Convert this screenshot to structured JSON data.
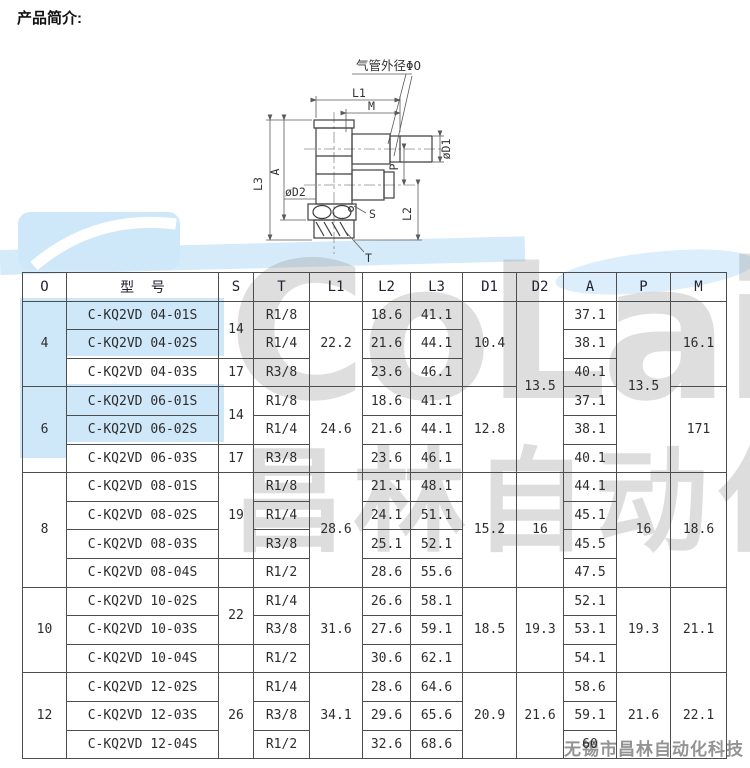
{
  "page": {
    "title": "产品简介:"
  },
  "watermark": {
    "brand": "CoLair",
    "cn": "昌林自动化",
    "footer": "无锡市昌林自动化科技",
    "blue": "#cfe8f9",
    "gray": "#919191"
  },
  "diagram": {
    "labels": {
      "tube_od": "气管外径ΦO",
      "l1": "L1",
      "m": "M",
      "l3": "L3",
      "a": "A",
      "od2": "øD2",
      "s": "S",
      "t": "T",
      "l2": "L2",
      "p": "P",
      "od1": "øD1"
    }
  },
  "table": {
    "headers": [
      "O",
      "型  号",
      "S",
      "T",
      "L1",
      "L2",
      "L3",
      "D1",
      "D2",
      "A",
      "P",
      "M"
    ],
    "rows": [
      [
        {
          "t": "4",
          "rs": 3
        },
        {
          "t": "C-KQ2VD 04-01S",
          "n": "model-cell"
        },
        {
          "t": "14",
          "rs": 2
        },
        {
          "t": "R1/8"
        },
        {
          "t": "22.2",
          "rs": 3
        },
        {
          "t": "18.6"
        },
        {
          "t": "41.1"
        },
        {
          "t": "10.4",
          "rs": 3
        },
        {
          "t": "13.5",
          "rs": 6
        },
        {
          "t": "37.1"
        },
        {
          "t": "13.5",
          "rs": 6
        },
        {
          "t": "16.1",
          "rs": 3
        }
      ],
      [
        {
          "t": "C-KQ2VD 04-02S",
          "n": "model-cell"
        },
        {
          "t": "R1/4"
        },
        {
          "t": "21.6"
        },
        {
          "t": "44.1"
        },
        {
          "t": "38.1"
        }
      ],
      [
        {
          "t": "C-KQ2VD 04-03S",
          "n": "model-cell"
        },
        {
          "t": "17"
        },
        {
          "t": "R3/8"
        },
        {
          "t": "23.6"
        },
        {
          "t": "46.1"
        },
        {
          "t": "40.1"
        }
      ],
      [
        {
          "t": "6",
          "rs": 3
        },
        {
          "t": "C-KQ2VD 06-01S",
          "n": "model-cell"
        },
        {
          "t": "14",
          "rs": 2
        },
        {
          "t": "R1/8"
        },
        {
          "t": "24.6",
          "rs": 3
        },
        {
          "t": "18.6"
        },
        {
          "t": "41.1"
        },
        {
          "t": "12.8",
          "rs": 3
        },
        {
          "t": "37.1"
        },
        {
          "t": "171",
          "rs": 3
        }
      ],
      [
        {
          "t": "C-KQ2VD 06-02S",
          "n": "model-cell"
        },
        {
          "t": "R1/4"
        },
        {
          "t": "21.6"
        },
        {
          "t": "44.1"
        },
        {
          "t": "38.1"
        }
      ],
      [
        {
          "t": "C-KQ2VD 06-03S",
          "n": "model-cell"
        },
        {
          "t": "17"
        },
        {
          "t": "R3/8"
        },
        {
          "t": "23.6"
        },
        {
          "t": "46.1"
        },
        {
          "t": "40.1"
        }
      ],
      [
        {
          "t": "8",
          "rs": 4
        },
        {
          "t": "C-KQ2VD 08-01S",
          "n": "model-cell"
        },
        {
          "t": "19",
          "rs": 3
        },
        {
          "t": "R1/8"
        },
        {
          "t": "28.6",
          "rs": 4
        },
        {
          "t": "21.1"
        },
        {
          "t": "48.1"
        },
        {
          "t": "15.2",
          "rs": 4
        },
        {
          "t": "16",
          "rs": 4
        },
        {
          "t": "44.1"
        },
        {
          "t": "16",
          "rs": 4
        },
        {
          "t": "18.6",
          "rs": 4
        }
      ],
      [
        {
          "t": "C-KQ2VD 08-02S",
          "n": "model-cell"
        },
        {
          "t": "R1/4"
        },
        {
          "t": "24.1"
        },
        {
          "t": "51.1"
        },
        {
          "t": "45.1"
        }
      ],
      [
        {
          "t": "C-KQ2VD 08-03S",
          "n": "model-cell"
        },
        {
          "t": "R3/8"
        },
        {
          "t": "25.1"
        },
        {
          "t": "52.1"
        },
        {
          "t": "45.5"
        }
      ],
      [
        {
          "t": "C-KQ2VD 08-04S",
          "n": "model-cell"
        },
        {
          "t": ""
        },
        {
          "t": "R1/2"
        },
        {
          "t": "28.6"
        },
        {
          "t": "55.6"
        },
        {
          "t": "47.5"
        }
      ],
      [
        {
          "t": "10",
          "rs": 3
        },
        {
          "t": "C-KQ2VD 10-02S",
          "n": "model-cell"
        },
        {
          "t": "22",
          "rs": 2
        },
        {
          "t": "R1/4"
        },
        {
          "t": "31.6",
          "rs": 3
        },
        {
          "t": "26.6"
        },
        {
          "t": "58.1"
        },
        {
          "t": "18.5",
          "rs": 3
        },
        {
          "t": "19.3",
          "rs": 3
        },
        {
          "t": "52.1"
        },
        {
          "t": "19.3",
          "rs": 3
        },
        {
          "t": "21.1",
          "rs": 3
        }
      ],
      [
        {
          "t": "C-KQ2VD 10-03S",
          "n": "model-cell"
        },
        {
          "t": "R3/8"
        },
        {
          "t": "27.6"
        },
        {
          "t": "59.1"
        },
        {
          "t": "53.1"
        }
      ],
      [
        {
          "t": "C-KQ2VD 10-04S",
          "n": "model-cell"
        },
        {
          "t": ""
        },
        {
          "t": "R1/2"
        },
        {
          "t": "30.6"
        },
        {
          "t": "62.1"
        },
        {
          "t": "54.1"
        }
      ],
      [
        {
          "t": "12",
          "rs": 3
        },
        {
          "t": "C-KQ2VD 12-02S",
          "n": "model-cell"
        },
        {
          "t": "26",
          "rs": 3
        },
        {
          "t": "R1/4"
        },
        {
          "t": "34.1",
          "rs": 3
        },
        {
          "t": "28.6"
        },
        {
          "t": "64.6"
        },
        {
          "t": "20.9",
          "rs": 3
        },
        {
          "t": "21.6",
          "rs": 3
        },
        {
          "t": "58.6"
        },
        {
          "t": "21.6",
          "rs": 3
        },
        {
          "t": "22.1",
          "rs": 3
        }
      ],
      [
        {
          "t": "C-KQ2VD 12-03S",
          "n": "model-cell"
        },
        {
          "t": "R3/8"
        },
        {
          "t": "29.6"
        },
        {
          "t": "65.6"
        },
        {
          "t": "59.1"
        }
      ],
      [
        {
          "t": "C-KQ2VD 12-04S",
          "n": "model-cell"
        },
        {
          "t": "R1/2"
        },
        {
          "t": "32.6"
        },
        {
          "t": "68.6"
        },
        {
          "t": "60"
        }
      ]
    ]
  }
}
